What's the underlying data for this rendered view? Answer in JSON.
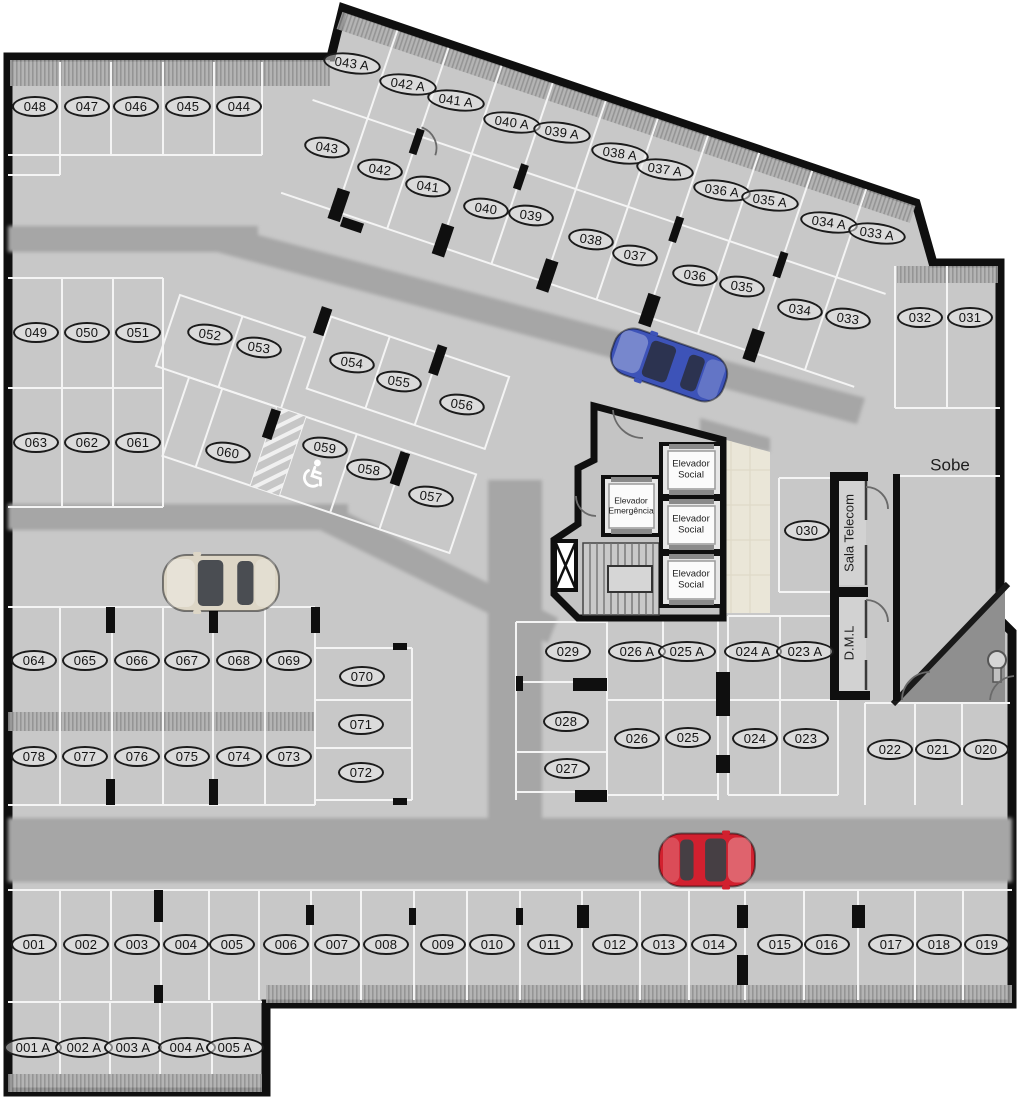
{
  "plan_title": "underground parking floor plan",
  "rooms": {
    "sobe": "Sobe",
    "sala_telecom": "Sala Telecom",
    "dml": "D.M.L",
    "elevador_social": "Elevador Social",
    "elevador_emergencia": "Elevador Emergência"
  },
  "symbols": {
    "handicap_spot": "059",
    "handicap_icon": "wheelchair-icon"
  },
  "colors": {
    "floor": "#c8c8c8",
    "aisle": "#a6a6a6",
    "wall": "#0f0f0f",
    "line": "#f4f4f4",
    "hall_tile": "#eae6d8",
    "ramp": "#8f8f8f",
    "car_blue": "#3d53b8",
    "car_silver": "#ddd6c6",
    "car_red": "#d2202f"
  },
  "cars": [
    {
      "name": "car-blue",
      "color": "#3d53b8",
      "glass": "#2c3350",
      "x": 669,
      "y": 365,
      "a": 19,
      "l": 118,
      "w": 48
    },
    {
      "name": "car-silver",
      "color": "#ddd6c6",
      "glass": "#4a4d52",
      "x": 221,
      "y": 583,
      "a": 0,
      "l": 116,
      "w": 56
    },
    {
      "name": "car-red",
      "color": "#d2202f",
      "glass": "#463f44",
      "x": 707,
      "y": 860,
      "a": 180,
      "l": 96,
      "w": 53
    }
  ],
  "spots": [
    {
      "id": "048",
      "x": 35,
      "y": 106
    },
    {
      "id": "047",
      "x": 87,
      "y": 106
    },
    {
      "id": "046",
      "x": 136,
      "y": 106
    },
    {
      "id": "045",
      "x": 188,
      "y": 106
    },
    {
      "id": "044",
      "x": 239,
      "y": 106
    },
    {
      "id": "043 A",
      "x": 352,
      "y": 63,
      "a": 8
    },
    {
      "id": "042 A",
      "x": 408,
      "y": 84,
      "a": 8
    },
    {
      "id": "041 A",
      "x": 456,
      "y": 100,
      "a": 8
    },
    {
      "id": "040 A",
      "x": 512,
      "y": 122,
      "a": 8
    },
    {
      "id": "039 A",
      "x": 562,
      "y": 132,
      "a": 8
    },
    {
      "id": "038 A",
      "x": 620,
      "y": 153,
      "a": 8
    },
    {
      "id": "037 A",
      "x": 665,
      "y": 169,
      "a": 8
    },
    {
      "id": "036 A",
      "x": 722,
      "y": 190,
      "a": 8
    },
    {
      "id": "035 A",
      "x": 770,
      "y": 200,
      "a": 8
    },
    {
      "id": "034 A",
      "x": 829,
      "y": 222,
      "a": 8
    },
    {
      "id": "033 A",
      "x": 877,
      "y": 233,
      "a": 8
    },
    {
      "id": "043",
      "x": 327,
      "y": 147,
      "a": 8
    },
    {
      "id": "042",
      "x": 380,
      "y": 169,
      "a": 8
    },
    {
      "id": "041",
      "x": 428,
      "y": 186,
      "a": 8
    },
    {
      "id": "040",
      "x": 486,
      "y": 208,
      "a": 8
    },
    {
      "id": "039",
      "x": 531,
      "y": 215,
      "a": 8
    },
    {
      "id": "038",
      "x": 591,
      "y": 239,
      "a": 8
    },
    {
      "id": "037",
      "x": 635,
      "y": 255,
      "a": 8
    },
    {
      "id": "036",
      "x": 695,
      "y": 275,
      "a": 8
    },
    {
      "id": "035",
      "x": 742,
      "y": 286,
      "a": 8
    },
    {
      "id": "034",
      "x": 800,
      "y": 309,
      "a": 8
    },
    {
      "id": "033",
      "x": 848,
      "y": 318,
      "a": 8
    },
    {
      "id": "032",
      "x": 920,
      "y": 317
    },
    {
      "id": "031",
      "x": 970,
      "y": 317
    },
    {
      "id": "049",
      "x": 36,
      "y": 332
    },
    {
      "id": "050",
      "x": 87,
      "y": 332
    },
    {
      "id": "051",
      "x": 138,
      "y": 332
    },
    {
      "id": "063",
      "x": 36,
      "y": 442
    },
    {
      "id": "062",
      "x": 87,
      "y": 442
    },
    {
      "id": "061",
      "x": 138,
      "y": 442
    },
    {
      "id": "052",
      "x": 210,
      "y": 334,
      "a": 8
    },
    {
      "id": "053",
      "x": 259,
      "y": 347,
      "a": 8
    },
    {
      "id": "054",
      "x": 352,
      "y": 362,
      "a": 8
    },
    {
      "id": "055",
      "x": 399,
      "y": 381,
      "a": 8
    },
    {
      "id": "056",
      "x": 462,
      "y": 404,
      "a": 8
    },
    {
      "id": "060",
      "x": 228,
      "y": 452,
      "a": 8
    },
    {
      "id": "059",
      "x": 325,
      "y": 447,
      "a": 8
    },
    {
      "id": "058",
      "x": 369,
      "y": 469,
      "a": 8
    },
    {
      "id": "057",
      "x": 431,
      "y": 496,
      "a": 8
    },
    {
      "id": "064",
      "x": 34,
      "y": 660
    },
    {
      "id": "065",
      "x": 85,
      "y": 660
    },
    {
      "id": "066",
      "x": 137,
      "y": 660
    },
    {
      "id": "067",
      "x": 187,
      "y": 660
    },
    {
      "id": "068",
      "x": 239,
      "y": 660
    },
    {
      "id": "069",
      "x": 289,
      "y": 660
    },
    {
      "id": "070",
      "x": 362,
      "y": 676
    },
    {
      "id": "071",
      "x": 361,
      "y": 724
    },
    {
      "id": "072",
      "x": 361,
      "y": 772
    },
    {
      "id": "078",
      "x": 34,
      "y": 756
    },
    {
      "id": "077",
      "x": 85,
      "y": 756
    },
    {
      "id": "076",
      "x": 137,
      "y": 756
    },
    {
      "id": "075",
      "x": 187,
      "y": 756
    },
    {
      "id": "074",
      "x": 239,
      "y": 756
    },
    {
      "id": "073",
      "x": 289,
      "y": 756
    },
    {
      "id": "029",
      "x": 568,
      "y": 651
    },
    {
      "id": "026 A",
      "x": 637,
      "y": 651
    },
    {
      "id": "025 A",
      "x": 687,
      "y": 651
    },
    {
      "id": "024 A",
      "x": 753,
      "y": 651
    },
    {
      "id": "023 A",
      "x": 805,
      "y": 651
    },
    {
      "id": "028",
      "x": 566,
      "y": 721
    },
    {
      "id": "026",
      "x": 637,
      "y": 738
    },
    {
      "id": "025",
      "x": 688,
      "y": 737
    },
    {
      "id": "024",
      "x": 755,
      "y": 738
    },
    {
      "id": "023",
      "x": 806,
      "y": 738
    },
    {
      "id": "027",
      "x": 567,
      "y": 768
    },
    {
      "id": "030",
      "x": 807,
      "y": 530
    },
    {
      "id": "022",
      "x": 890,
      "y": 749
    },
    {
      "id": "021",
      "x": 938,
      "y": 749
    },
    {
      "id": "020",
      "x": 986,
      "y": 749
    },
    {
      "id": "001",
      "x": 34,
      "y": 944
    },
    {
      "id": "002",
      "x": 86,
      "y": 944
    },
    {
      "id": "003",
      "x": 137,
      "y": 944
    },
    {
      "id": "004",
      "x": 186,
      "y": 944
    },
    {
      "id": "005",
      "x": 232,
      "y": 944
    },
    {
      "id": "006",
      "x": 286,
      "y": 944
    },
    {
      "id": "007",
      "x": 337,
      "y": 944
    },
    {
      "id": "008",
      "x": 386,
      "y": 944
    },
    {
      "id": "009",
      "x": 443,
      "y": 944
    },
    {
      "id": "010",
      "x": 492,
      "y": 944
    },
    {
      "id": "011",
      "x": 550,
      "y": 944
    },
    {
      "id": "012",
      "x": 615,
      "y": 944
    },
    {
      "id": "013",
      "x": 664,
      "y": 944
    },
    {
      "id": "014",
      "x": 714,
      "y": 944
    },
    {
      "id": "015",
      "x": 780,
      "y": 944
    },
    {
      "id": "016",
      "x": 827,
      "y": 944
    },
    {
      "id": "017",
      "x": 891,
      "y": 944
    },
    {
      "id": "018",
      "x": 939,
      "y": 944
    },
    {
      "id": "019",
      "x": 987,
      "y": 944
    },
    {
      "id": "001 A",
      "x": 33,
      "y": 1047
    },
    {
      "id": "002 A",
      "x": 84,
      "y": 1047
    },
    {
      "id": "003 A",
      "x": 133,
      "y": 1047
    },
    {
      "id": "004 A",
      "x": 187,
      "y": 1047
    },
    {
      "id": "005 A",
      "x": 235,
      "y": 1047
    }
  ]
}
